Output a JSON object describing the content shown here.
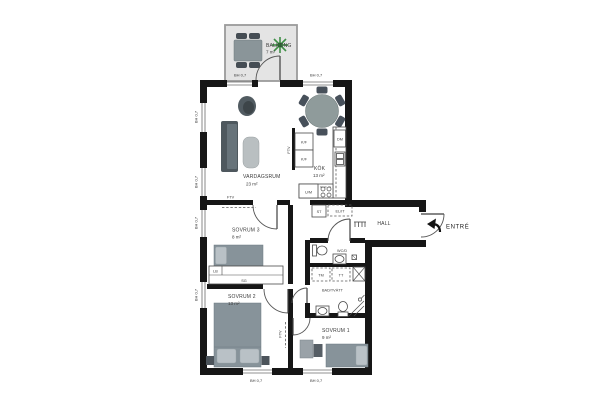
{
  "plan": {
    "rooms": {
      "balkong": {
        "name": "BALKONG",
        "area": "7 m²"
      },
      "vardagsrum": {
        "name": "VARDAGSRUM",
        "area": "23 m²"
      },
      "kok": {
        "name": "KÖK",
        "area": "13 m²"
      },
      "sovrum3": {
        "name": "SOVRUM 3",
        "area": "8 m²"
      },
      "sovrum2": {
        "name": "SOVRUM 2",
        "area": "13 m²"
      },
      "sovrum1": {
        "name": "SOVRUM 1",
        "area": "9 m²"
      },
      "hall": {
        "name": "HALL"
      },
      "wcd": {
        "name": "WC/D"
      },
      "bad": {
        "name": "BAD/TVÄTT"
      }
    },
    "entrance_label": "ENTRÉ",
    "window_label": "BH 0,7",
    "fixtures": {
      "fridge": "K/F",
      "dishwasher": "DM",
      "oven_micro": "U/M",
      "washer": "TM",
      "dryer": "TT",
      "cleaning_cabinet": "ST",
      "electrical_cabinet": "EL/IT",
      "linen_cabinet": "LB",
      "sliding_wardrobe": "SG",
      "vent": "FTV"
    },
    "colors": {
      "wall": "#161616",
      "balcony_floor": "#e4e4e4",
      "furniture": "#87939a",
      "furniture_dark": "#454d54",
      "pillow": "#b9c1c6",
      "plant": "#3f8f46"
    }
  }
}
